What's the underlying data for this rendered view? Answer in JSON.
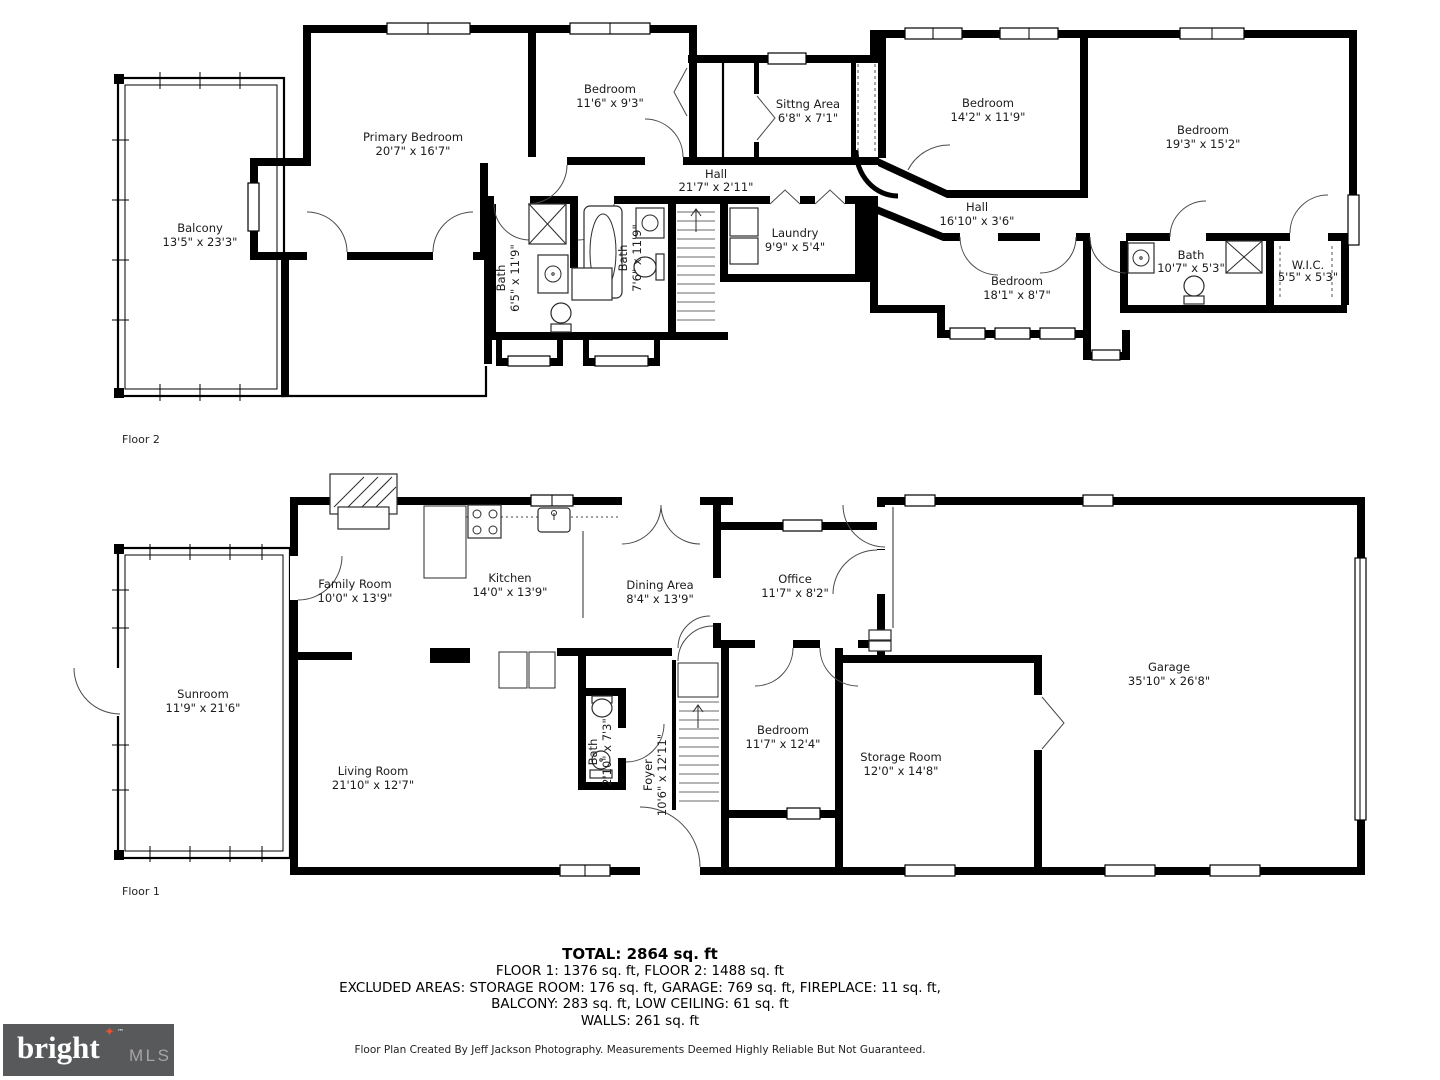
{
  "floor2": {
    "label": "Floor 2",
    "rooms": [
      {
        "name": "Balcony",
        "dims": "13'5\" x 23'3\""
      },
      {
        "name": "Primary Bedroom",
        "dims": "20'7\" x 16'7\""
      },
      {
        "name": "Bedroom",
        "dims": "11'6\" x 9'3\""
      },
      {
        "name": "Sittng Area",
        "dims": "6'8\" x 7'1\""
      },
      {
        "name": "Bedroom",
        "dims": "14'2\" x 11'9\""
      },
      {
        "name": "Bedroom",
        "dims": "19'3\" x 15'2\""
      },
      {
        "name": "Hall",
        "dims": "21'7\" x 2'11\""
      },
      {
        "name": "Hall",
        "dims": "16'10\" x 3'6\""
      },
      {
        "name": "Laundry",
        "dims": "9'9\" x 5'4\""
      },
      {
        "name": "Bath",
        "dims": "6'5\" x 11'9\""
      },
      {
        "name": "Bath",
        "dims": "7'6\" x 11'9\""
      },
      {
        "name": "Bedroom",
        "dims": "18'1\" x 8'7\""
      },
      {
        "name": "Bath",
        "dims": "10'7\" x 5'3\""
      },
      {
        "name": "W.I.C.",
        "dims": "5'5\" x 5'3\""
      }
    ]
  },
  "floor1": {
    "label": "Floor 1",
    "rooms": [
      {
        "name": "Sunroom",
        "dims": "11'9\" x 21'6\""
      },
      {
        "name": "Family Room",
        "dims": "10'0\" x 13'9\""
      },
      {
        "name": "Kitchen",
        "dims": "14'0\" x 13'9\""
      },
      {
        "name": "Dining Area",
        "dims": "8'4\" x 13'9\""
      },
      {
        "name": "Office",
        "dims": "11'7\" x 8'2\""
      },
      {
        "name": "Living Room",
        "dims": "21'10\" x 12'7\""
      },
      {
        "name": "Bath",
        "dims": "2'10\" x 7'3\""
      },
      {
        "name": "Foyer",
        "dims": "10'6\" x 12'11\""
      },
      {
        "name": "Bedroom",
        "dims": "11'7\" x 12'4\""
      },
      {
        "name": "Storage Room",
        "dims": "12'0\" x 14'8\""
      },
      {
        "name": "Garage",
        "dims": "35'10\" x 26'8\""
      }
    ]
  },
  "summary": {
    "total": "TOTAL: 2864 sq. ft",
    "floors": "FLOOR 1: 1376 sq. ft, FLOOR 2: 1488 sq. ft",
    "excluded_1": "EXCLUDED AREAS: STORAGE ROOM: 176 sq. ft, GARAGE: 769 sq. ft, FIREPLACE: 11 sq. ft,",
    "excluded_2": "BALCONY: 283 sq. ft, LOW CEILING: 61 sq. ft",
    "walls": "WALLS: 261 sq. ft"
  },
  "credit": "Floor Plan Created By Jeff Jackson Photography. Measurements Deemed Highly Reliable But Not Guaranteed.",
  "logo": {
    "brand": "bright",
    "tm": "™",
    "suffix": "MLS",
    "star": "✦",
    "bg_color": "#58595b",
    "brand_color": "#ffffff",
    "suffix_color": "#a7a5a6",
    "star_color": "#e8502e"
  }
}
